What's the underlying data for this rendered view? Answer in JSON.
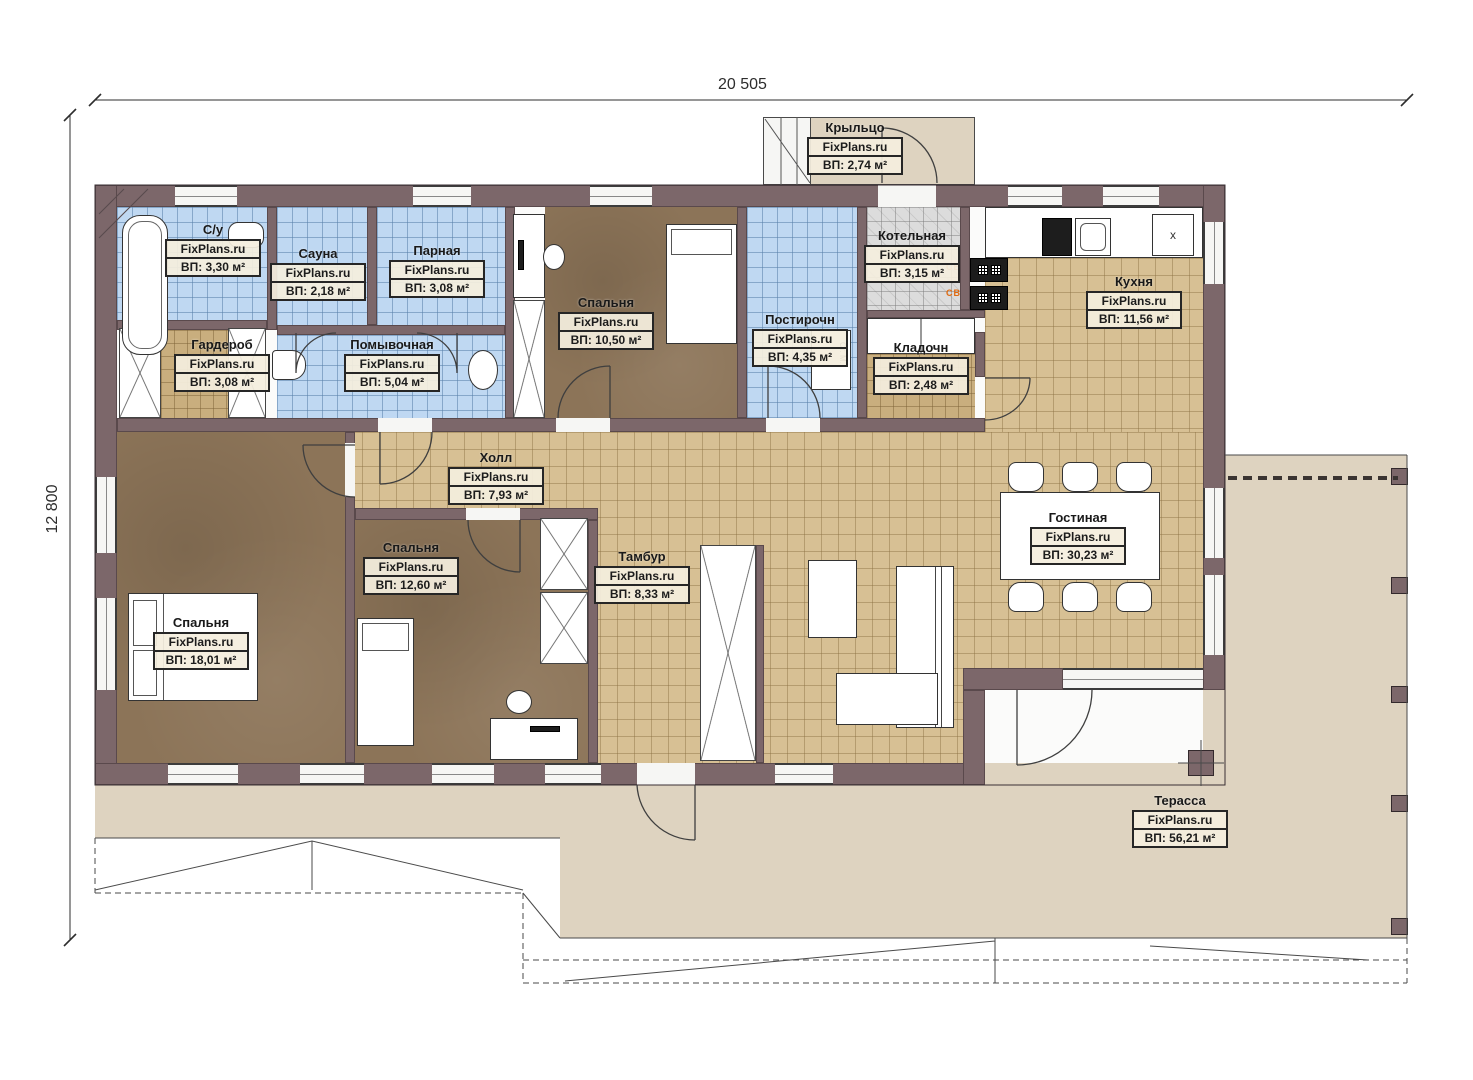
{
  "meta": {
    "brand": "FixPlans.ru"
  },
  "dimensions": {
    "width_label": "20 505",
    "height_label": "12 800"
  },
  "rooms": [
    {
      "id": "kryltso",
      "name": "Крыльцо",
      "area": "ВП: 2,74 м²"
    },
    {
      "id": "su",
      "name": "С/у",
      "area": "ВП: 3,30 м²"
    },
    {
      "id": "sauna",
      "name": "Сауна",
      "area": "ВП: 2,18 м²"
    },
    {
      "id": "parnaya",
      "name": "Парная",
      "area": "ВП: 3,08 м²"
    },
    {
      "id": "garderob",
      "name": "Гардероб",
      "area": "ВП: 3,08 м²"
    },
    {
      "id": "pomyvochnaya",
      "name": "Помывочная",
      "area": "ВП: 5,04 м²"
    },
    {
      "id": "spalnya-1",
      "name": "Спальня",
      "area": "ВП: 10,50 м²"
    },
    {
      "id": "postirochn",
      "name": "Постирочн",
      "area": "ВП: 4,35 м²"
    },
    {
      "id": "kotelnaya",
      "name": "Котельная",
      "area": "ВП: 3,15 м²"
    },
    {
      "id": "kladochn",
      "name": "Кладочн",
      "area": "ВП: 2,48 м²"
    },
    {
      "id": "kukhnya",
      "name": "Кухня",
      "area": "ВП: 11,56 м²"
    },
    {
      "id": "kholl",
      "name": "Холл",
      "area": "ВП: 7,93 м²"
    },
    {
      "id": "spalnya-2",
      "name": "Спальня",
      "area": "ВП: 12,60 м²"
    },
    {
      "id": "tambur",
      "name": "Тамбур",
      "area": "ВП: 8,33 м²"
    },
    {
      "id": "gostinaya",
      "name": "Гостиная",
      "area": "ВП: 30,23 м²"
    },
    {
      "id": "spalnya-3",
      "name": "Спальня",
      "area": "ВП: 18,01 м²"
    },
    {
      "id": "terassa",
      "name": "Терасса",
      "area": "ВП: 56,21 м²"
    }
  ],
  "annotations": {
    "washer_label": "Ст. М.",
    "fridge_label": "x",
    "stove_display": "СВ"
  },
  "colors": {
    "wall": "#7c676a",
    "tile_blue": "#bfd8f2",
    "tile_tan": "#d7c094",
    "tile_tan_small": "#c9ae7e",
    "tile_gray": "#dcdcdc",
    "floor_brown": "#8c7458",
    "terrace": "#ded3c0",
    "accent_orange": "#e06a10"
  }
}
